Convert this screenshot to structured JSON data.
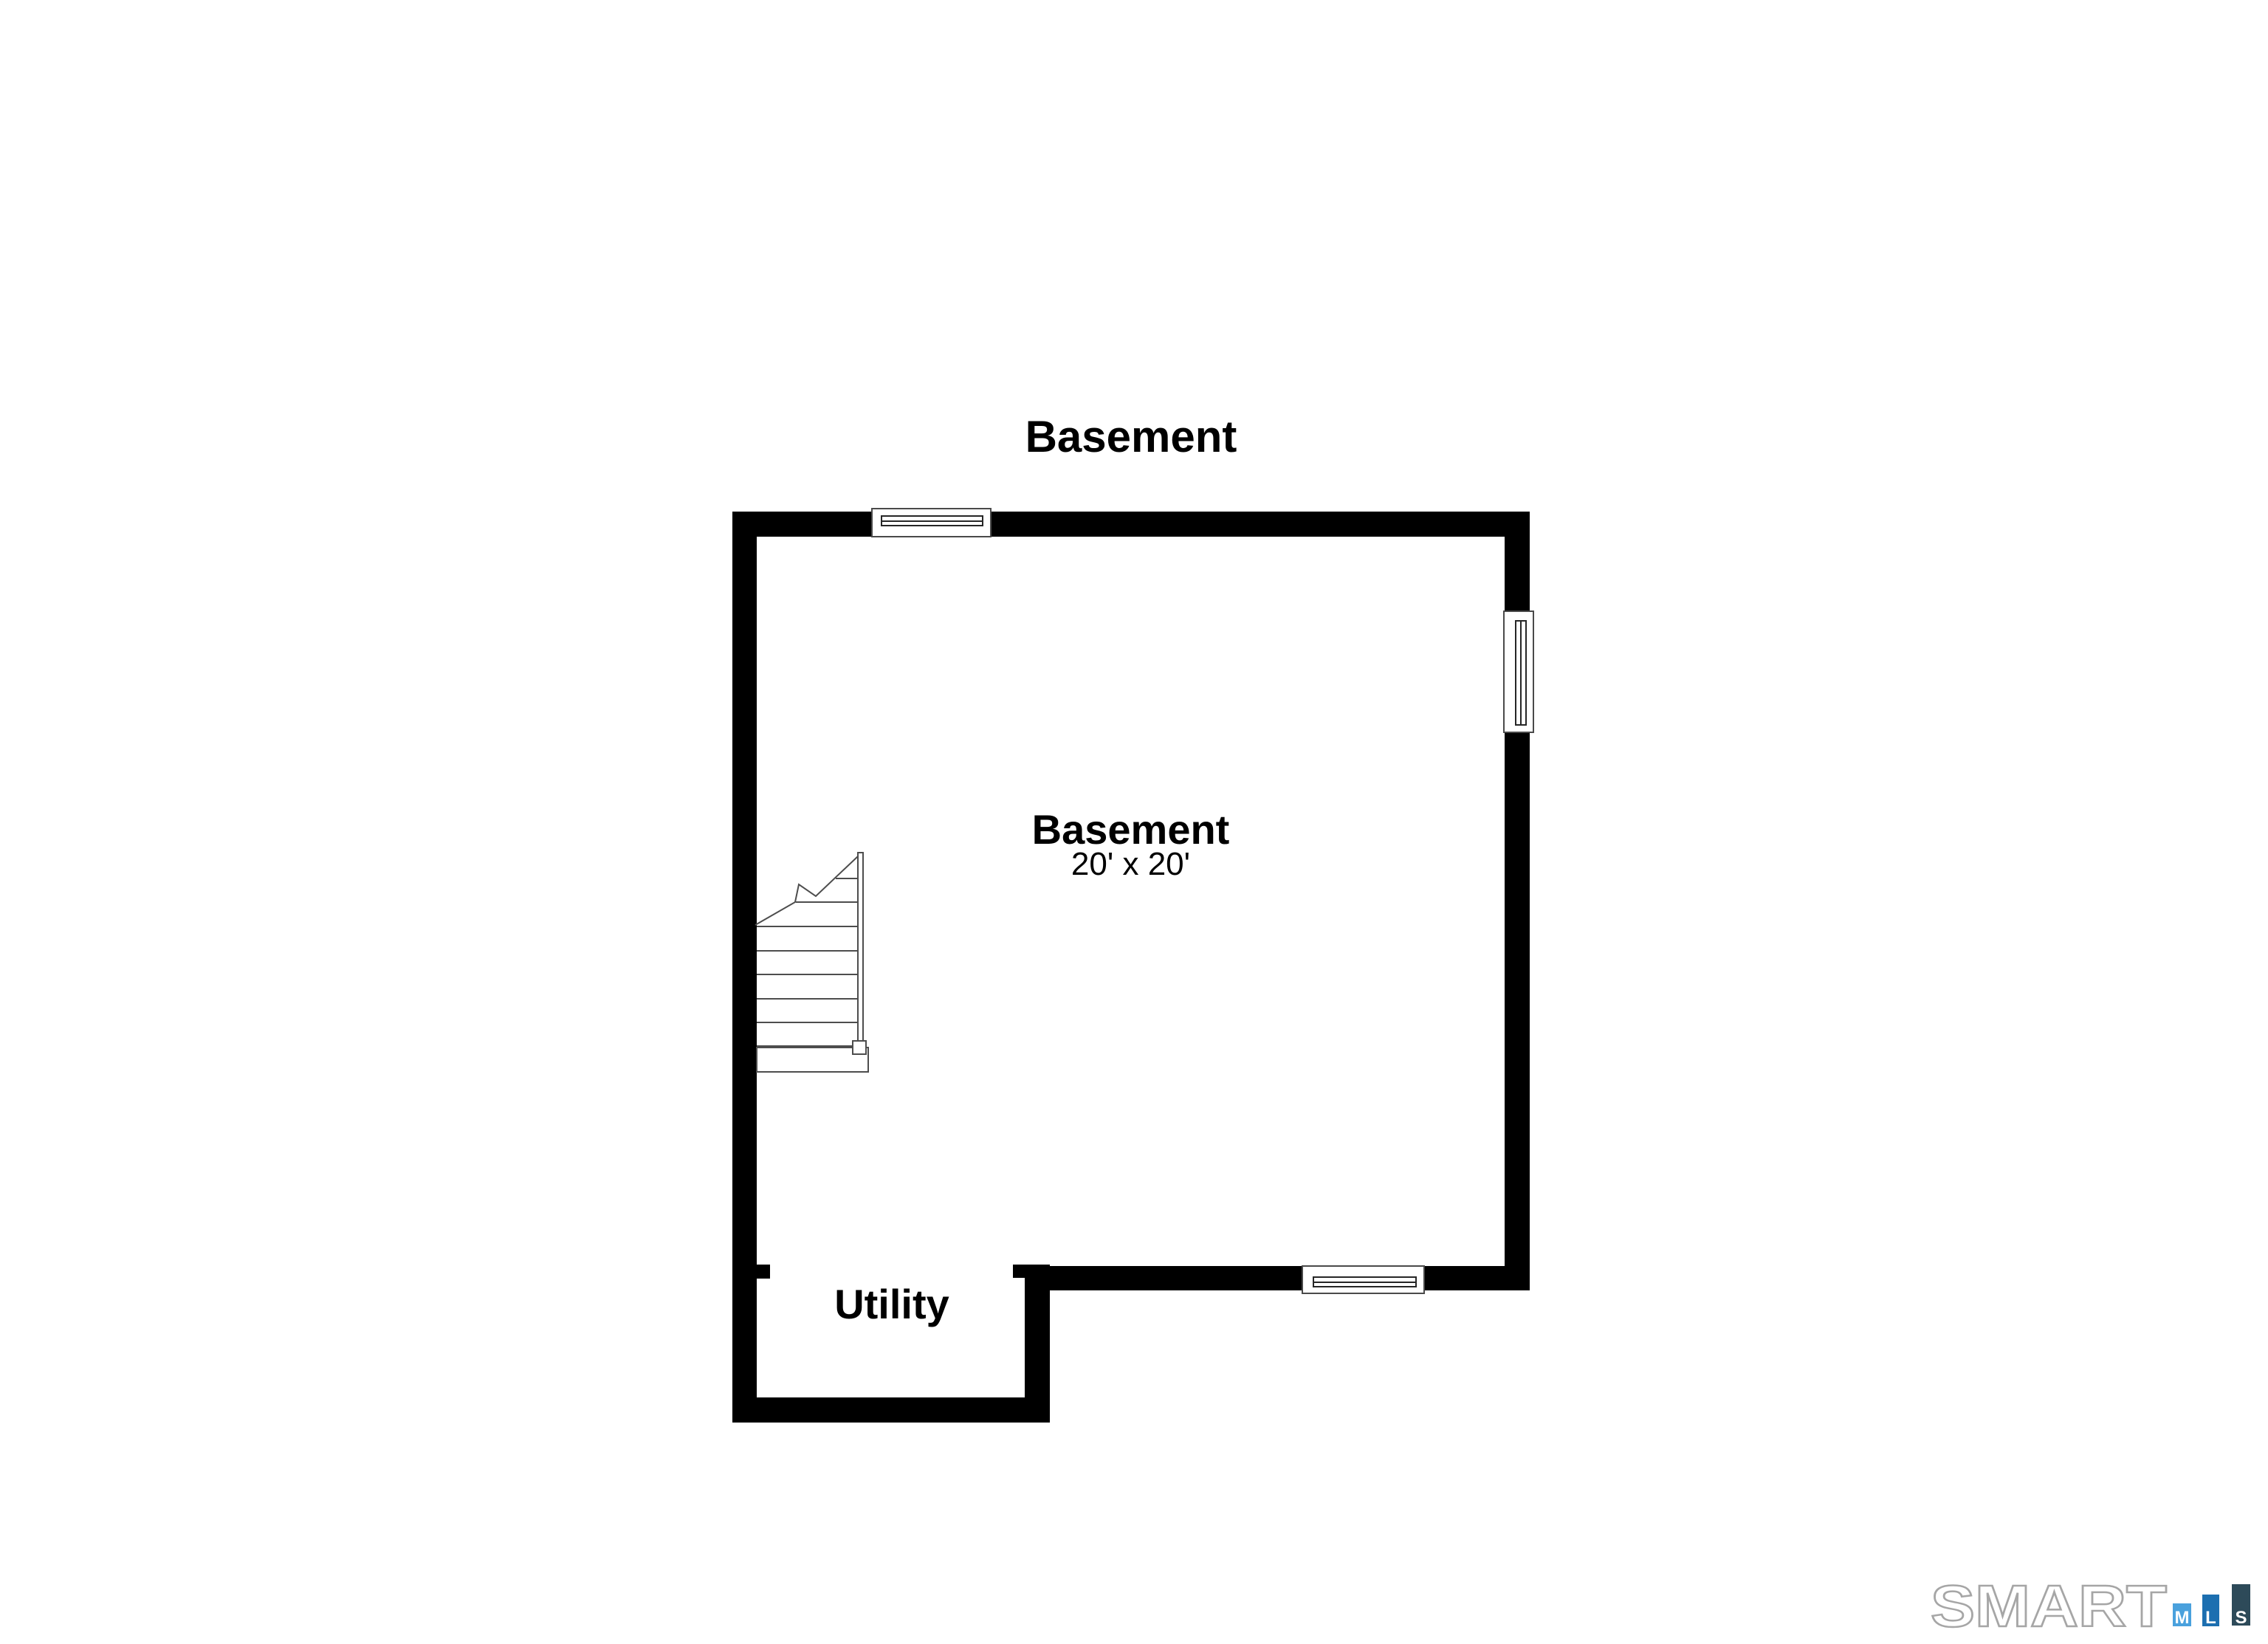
{
  "page": {
    "background": "#ffffff"
  },
  "plan": {
    "title": "Basement",
    "wall_color": "#000000",
    "rooms": {
      "basement": {
        "name": "Basement",
        "dims": "20' x 20'"
      },
      "utility": {
        "name": "Utility"
      }
    }
  },
  "logo": {
    "brand": "SMART",
    "bars": [
      {
        "label": "M",
        "color": "#4aa1dd"
      },
      {
        "label": "L",
        "color": "#1c6fb0"
      },
      {
        "label": "S",
        "color": "#2d4a59"
      }
    ]
  }
}
